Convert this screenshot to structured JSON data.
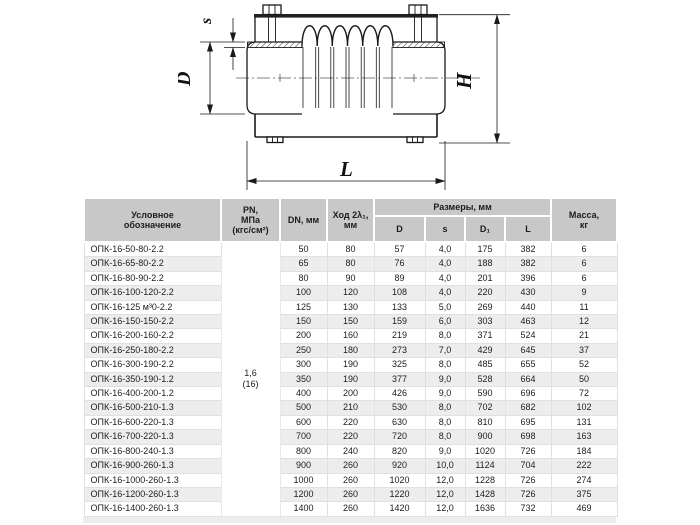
{
  "drawing": {
    "labels": {
      "s": "s",
      "D": "D",
      "H": "H",
      "L": "L"
    },
    "line_color": "#1a1a1a"
  },
  "table": {
    "headers": {
      "designation": "Условное\nобозначение",
      "pn": "PN,\nМПа\n(кгс/см²)",
      "dn": "DN, мм",
      "stroke": "Ход 2λ₁,\nмм",
      "sizes_group": "Размеры, мм",
      "d": "D",
      "s": "s",
      "d1": "D₁",
      "l": "L",
      "mass": "Масса,\nкг"
    },
    "pn_value": "1,6\n(16)",
    "rows": [
      [
        "ОПК-16-50-80-2.2",
        "50",
        "80",
        "57",
        "4,0",
        "175",
        "382",
        "6"
      ],
      [
        "ОПК-16-65-80-2.2",
        "65",
        "80",
        "76",
        "4,0",
        "188",
        "382",
        "6"
      ],
      [
        "ОПК-16-80-90-2.2",
        "80",
        "90",
        "89",
        "4,0",
        "201",
        "396",
        "6"
      ],
      [
        "ОПК-16-100-120-2.2",
        "100",
        "120",
        "108",
        "4,0",
        "220",
        "430",
        "9"
      ],
      [
        "ОПК-16-125 м³0-2.2",
        "125",
        "130",
        "133",
        "5,0",
        "269",
        "440",
        "11"
      ],
      [
        "ОПК-16-150-150-2.2",
        "150",
        "150",
        "159",
        "6,0",
        "303",
        "463",
        "12"
      ],
      [
        "ОПК-16-200-160-2.2",
        "200",
        "160",
        "219",
        "8,0",
        "371",
        "524",
        "21"
      ],
      [
        "ОПК-16-250-180-2.2",
        "250",
        "180",
        "273",
        "7,0",
        "429",
        "645",
        "37"
      ],
      [
        "ОПК-16-300-190-2.2",
        "300",
        "190",
        "325",
        "8,0",
        "485",
        "655",
        "52"
      ],
      [
        "ОПК-16-350-190-1.2",
        "350",
        "190",
        "377",
        "9,0",
        "528",
        "664",
        "50"
      ],
      [
        "ОПК-16-400-200-1.2",
        "400",
        "200",
        "426",
        "9,0",
        "590",
        "696",
        "72"
      ],
      [
        "ОПК-16-500-210-1.3",
        "500",
        "210",
        "530",
        "8,0",
        "702",
        "682",
        "102"
      ],
      [
        "ОПК-16-600-220-1.3",
        "600",
        "220",
        "630",
        "8,0",
        "810",
        "695",
        "131"
      ],
      [
        "ОПК-16-700-220-1.3",
        "700",
        "220",
        "720",
        "8,0",
        "900",
        "698",
        "163"
      ],
      [
        "ОПК-16-800-240-1.3",
        "800",
        "240",
        "820",
        "9,0",
        "1020",
        "726",
        "184"
      ],
      [
        "ОПК-16-900-260-1.3",
        "900",
        "260",
        "920",
        "10,0",
        "1124",
        "704",
        "222"
      ],
      [
        "ОПК-16-1000-260-1.3",
        "1000",
        "260",
        "1020",
        "12,0",
        "1228",
        "726",
        "274"
      ],
      [
        "ОПК-16-1200-260-1.3",
        "1200",
        "260",
        "1220",
        "12,0",
        "1428",
        "726",
        "375"
      ],
      [
        "ОПК-16-1400-260-1.3",
        "1400",
        "260",
        "1420",
        "12,0",
        "1636",
        "732",
        "469"
      ]
    ]
  },
  "colors": {
    "header_bg": "#c8c8c8",
    "row_alt_bg": "#ededed",
    "grid_line": "#e0e0e0",
    "text": "#1c1c1c",
    "drawing_line": "#1a1a1a"
  }
}
